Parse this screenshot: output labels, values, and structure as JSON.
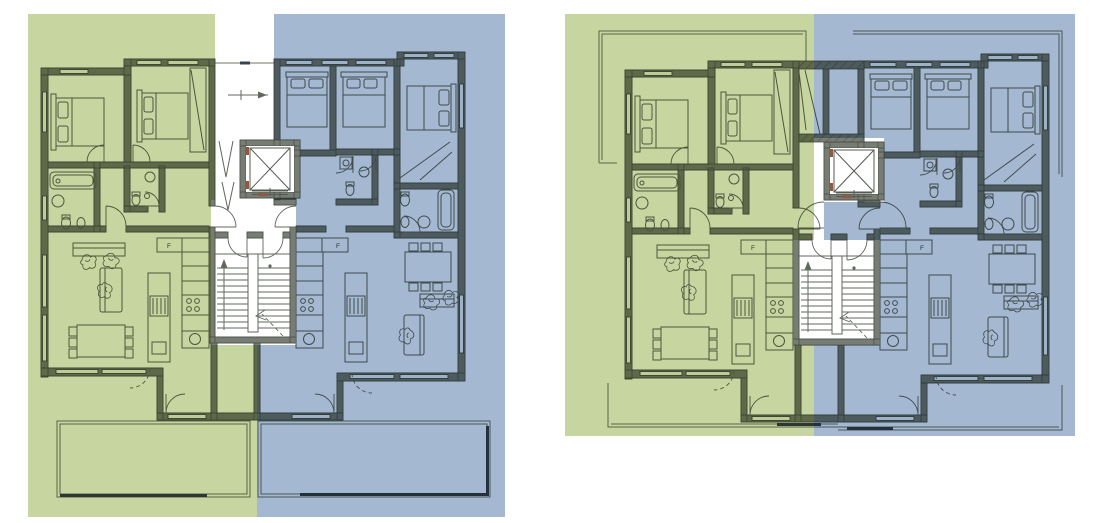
{
  "colors": {
    "background": "#ffffff",
    "unit_green_overlay": "#c7d5a1",
    "unit_blue_overlay": "#a4b9d1",
    "wall": "#787d74",
    "linework": "#60675d",
    "window_frame": "#454e48",
    "dark_fitting": "#39434d",
    "elevator_accent": "#8a5a44"
  },
  "labels": {
    "fridge": "F"
  },
  "plans": [
    {
      "name": "left-floor-plan",
      "units": [
        {
          "id": "unit-green",
          "side": "left",
          "tint": "green",
          "bedrooms": 2
        },
        {
          "id": "unit-blue",
          "side": "right",
          "tint": "blue",
          "bedrooms": 3
        }
      ],
      "features": {
        "entrance_canopy": true,
        "stair_core": true,
        "elevator": true,
        "terraces": 2
      }
    },
    {
      "name": "right-floor-plan",
      "units": [
        {
          "id": "unit-green",
          "side": "left",
          "tint": "green",
          "bedrooms": 2
        },
        {
          "id": "unit-blue",
          "side": "right",
          "tint": "blue",
          "bedrooms": 3
        }
      ],
      "features": {
        "roof_outline": true,
        "stair_core": true,
        "elevator": true,
        "balcony": true
      }
    }
  ]
}
